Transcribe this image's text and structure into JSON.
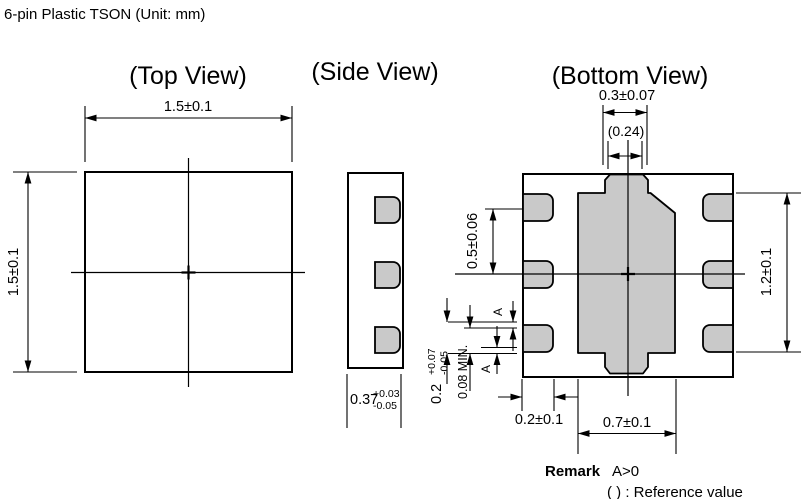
{
  "title": "6-pin Plastic TSON (Unit: mm)",
  "top_view": {
    "label": "(Top View)",
    "width_dim": "1.5±0.1",
    "height_dim": "1.5±0.1"
  },
  "side_view": {
    "label": "(Side View)",
    "thickness": {
      "base": "0.37",
      "plus": "+0.03",
      "minus": "-0.05"
    }
  },
  "bottom_view": {
    "label": "(Bottom View)",
    "tab_width_dim": "0.3±0.07",
    "tab_width_ref": "(0.24)",
    "pad_pitch_dim": "0.5±0.06",
    "pad_row_span_dim": "1.2±0.1",
    "pad_width_dim": "0.2±0.1",
    "center_pad_width_dim": "0.7±0.1",
    "terminal_length": {
      "base": "0.2",
      "plus": "+0.07",
      "minus": "-0.05"
    },
    "min_clearance_dim": "0.08 MIN.",
    "pullback_top_label": "A",
    "pullback_bottom_label": "A"
  },
  "remark": {
    "label": "Remark",
    "condition": "A>0",
    "reference_note": "( ) : Reference value"
  },
  "colors": {
    "pad_fill": "#c9c9c9",
    "line": "#000000",
    "background": "#ffffff"
  }
}
